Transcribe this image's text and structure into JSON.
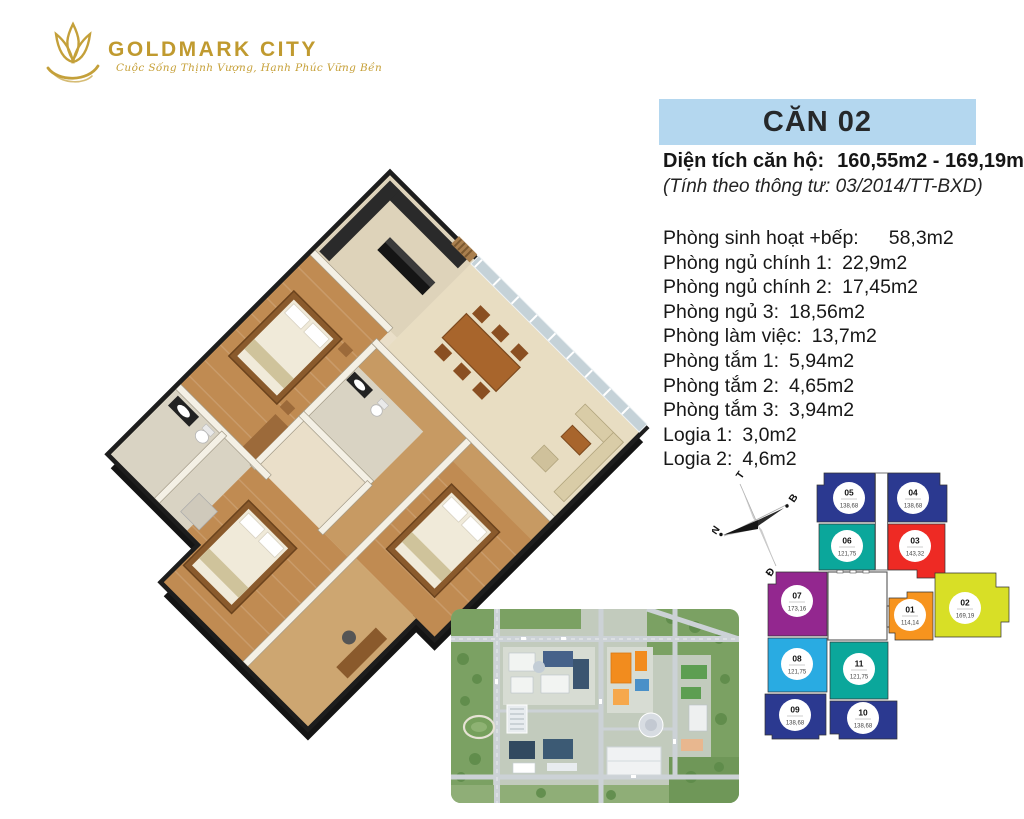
{
  "brand": {
    "name": "GOLDMARK CITY",
    "tagline": "Cuộc Sống Thịnh Vượng, Hạnh Phúc Vững Bền"
  },
  "unit_header": {
    "title": "CĂN 02",
    "area_label": "Diện tích căn hộ:",
    "area_range": "160,55m2 - 169,19m2",
    "regulation": "(Tính theo thông tư: 03/2014/TT-BXD)"
  },
  "rooms": [
    {
      "label": "Phòng sinh hoạt +bếp:",
      "area": "58,3m2"
    },
    {
      "label": "Phòng ngủ chính 1:",
      "area": "22,9m2"
    },
    {
      "label": "Phòng ngủ chính 2:",
      "area": "17,45m2"
    },
    {
      "label": "Phòng ngủ 3:",
      "area": "18,56m2"
    },
    {
      "label": "Phòng làm việc:",
      "area": "13,7m2"
    },
    {
      "label": "Phòng tắm 1:",
      "area": "5,94m2"
    },
    {
      "label": "Phòng tắm 2:",
      "area": "4,65m2"
    },
    {
      "label": "Phòng tắm 3:",
      "area": "3,94m2"
    },
    {
      "label": "Logia 1:",
      "area": "3,0m2"
    },
    {
      "label": "Logia 2:",
      "area": "4,6m2"
    }
  ],
  "compass": {
    "west": "T",
    "north": "B",
    "south": "N",
    "east": "Đ"
  },
  "floor_plate": {
    "highlighted": "02",
    "units": [
      {
        "id": "05",
        "area": "138,68",
        "color": "#2b3990"
      },
      {
        "id": "04",
        "area": "138,68",
        "color": "#2b3990"
      },
      {
        "id": "06",
        "area": "121,75",
        "color": "#0ba79b"
      },
      {
        "id": "03",
        "area": "143,32",
        "color": "#ee2a24"
      },
      {
        "id": "07",
        "area": "173,16",
        "color": "#93278f"
      },
      {
        "id": "01",
        "area": "114,14",
        "color": "#f7941e"
      },
      {
        "id": "02",
        "area": "169,19",
        "color": "#d8df26"
      },
      {
        "id": "08",
        "area": "121,75",
        "color": "#29abe2"
      },
      {
        "id": "11",
        "area": "121,75",
        "color": "#0ba79b"
      },
      {
        "id": "09",
        "area": "138,68",
        "color": "#2b3990"
      },
      {
        "id": "10",
        "area": "138,68",
        "color": "#2b3990"
      }
    ]
  },
  "colors": {
    "header_bg": "#b4d7ef",
    "brand_gold": "#c09a2f",
    "wall_dark": "#1d1d1d",
    "floor_cream": "#eadfc9",
    "floor_wood": "#c08b52"
  }
}
